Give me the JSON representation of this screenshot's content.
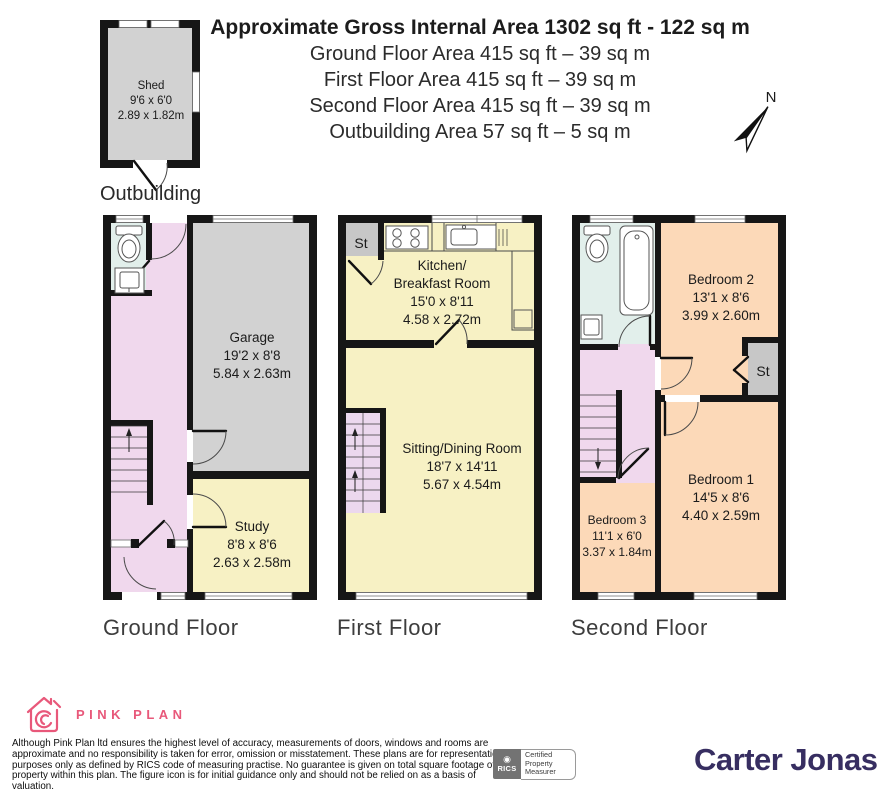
{
  "header": {
    "title": "Approximate Gross Internal Area 1302 sq ft - 122 sq m",
    "lines": [
      "Ground Floor Area 415 sq ft – 39 sq m",
      "First Floor Area 415 sq ft – 39 sq m",
      "Second Floor Area 415 sq ft – 39 sq m",
      "Outbuilding Area 57 sq ft – 5 sq m"
    ]
  },
  "compass": {
    "label": "N"
  },
  "outbuilding": {
    "caption": "Outbuilding",
    "rooms": {
      "shed": {
        "name": "Shed",
        "dims_ft": "9'6 x 6'0",
        "dims_m": "2.89 x 1.82m"
      }
    }
  },
  "floors": {
    "ground": {
      "caption": "Ground Floor",
      "rooms": {
        "garage": {
          "name": "Garage",
          "dims_ft": "19'2 x 8'8",
          "dims_m": "5.84 x 2.63m"
        },
        "study": {
          "name": "Study",
          "dims_ft": "8'8 x 8'6",
          "dims_m": "2.63 x 2.58m"
        }
      }
    },
    "first": {
      "caption": "First Floor",
      "rooms": {
        "kitchen": {
          "name_line1": "Kitchen/",
          "name_line2": "Breakfast Room",
          "dims_ft": "15'0 x 8'11",
          "dims_m": "4.58 x 2.72m"
        },
        "sitting": {
          "name": "Sitting/Dining Room",
          "dims_ft": "18'7 x 14'11",
          "dims_m": "5.67 x 4.54m"
        },
        "store": {
          "name": "St"
        }
      }
    },
    "second": {
      "caption": "Second Floor",
      "rooms": {
        "bedroom2": {
          "name": "Bedroom 2",
          "dims_ft": "13'1 x 8'6",
          "dims_m": "3.99 x 2.60m"
        },
        "bedroom1": {
          "name": "Bedroom 1",
          "dims_ft": "14'5 x 8'6",
          "dims_m": "4.40 x 2.59m"
        },
        "bedroom3": {
          "name": "Bedroom 3",
          "dims_ft": "11'1 x 6'0",
          "dims_m": "3.37 x 1.84m"
        },
        "store": {
          "name": "St"
        }
      }
    }
  },
  "footer": {
    "brand": {
      "name": "PINK PLAN"
    },
    "disclaimer_lines": [
      "Although Pink Plan ltd ensures the highest level of accuracy, measurements of doors, windows and rooms are",
      "approximate and no responsibility is taken for error, omission or misstatement. These plans are for representation",
      "purposes only as defined by RICS code of measuring practise. No guarantee is given on total square footage of the",
      "property within this plan. The figure icon is for initial guidance only and should not be relied on as a basis of valuation."
    ],
    "rics": {
      "logo": "RICS",
      "cert_lines": [
        "Certified",
        "Property",
        "Measurer"
      ]
    },
    "agent": "Carter Jonas"
  },
  "colors": {
    "wall": "#161616",
    "hallway_pink": "#f0d8ed",
    "room_yellow": "#f7f1c4",
    "bedroom_peach": "#fcd9b8",
    "bathroom_blue": "#e2efeb",
    "garage_grey": "#d2d2d2",
    "store_grey": "#c7c7c7",
    "brand_pink": "#e8587a",
    "agent_purple": "#372e61"
  }
}
